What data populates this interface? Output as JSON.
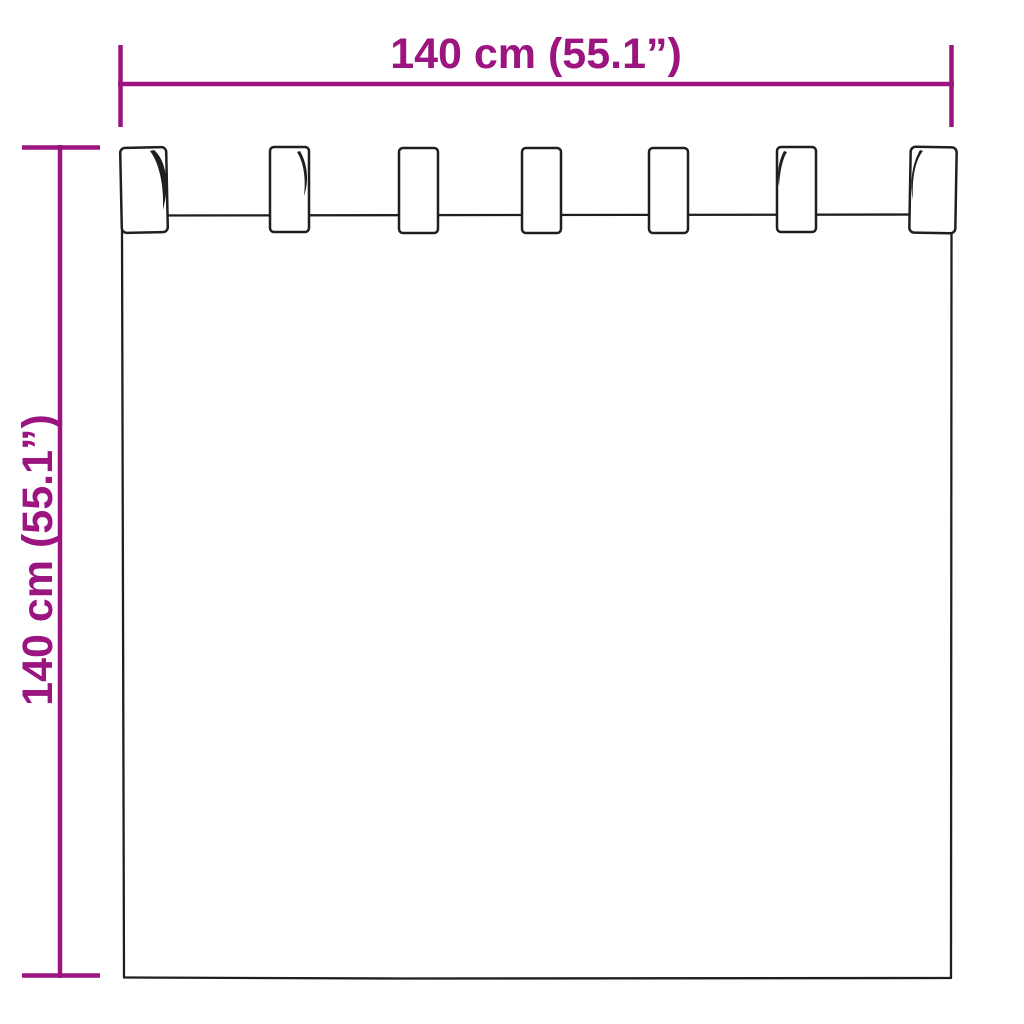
{
  "diagram": {
    "type": "product-dimension-diagram",
    "subject": "tab-top curtain panel",
    "width_label": "140 cm (55.1”)",
    "height_label": "140 cm (55.1”)",
    "width_cm": 140,
    "width_inches": 55.1,
    "height_cm": 140,
    "height_inches": 55.1,
    "tab_count": 7,
    "colors": {
      "dimension": "#9B1480",
      "outline": "#1F1F1F",
      "background": "#FFFFFF"
    }
  }
}
